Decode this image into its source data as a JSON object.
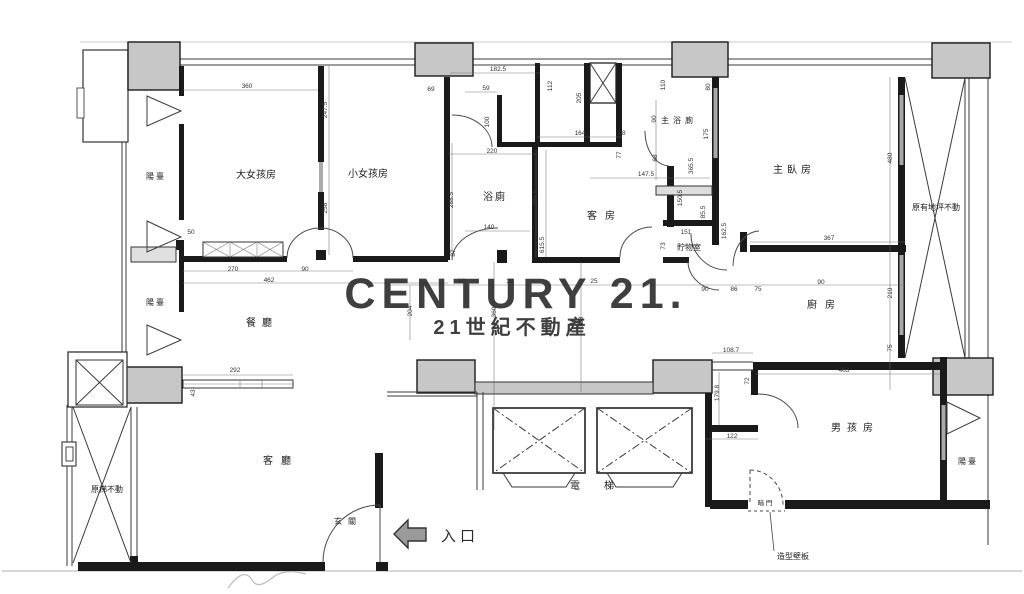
{
  "watermark": {
    "line1": "CENTURY 21.",
    "line2": "21世紀不動產",
    "color": "#c8b083"
  },
  "rooms": {
    "balcony_top_left": "陽臺",
    "balcony_mid_left": "陽臺",
    "balcony_bottom_right": "陽臺",
    "girl_big": "大女孩房",
    "girl_small": "小女孩房",
    "bath": "浴廁",
    "guest": "客房",
    "master_bath": "主浴廁",
    "master": "主臥房",
    "dining": "餐廳",
    "storage": "貯物室",
    "kitchen": "廚房",
    "living": "客廳",
    "entry": "玄關",
    "elevator": "電梯",
    "boy": "男孩房"
  },
  "notes": {
    "stair_note": "原梯不動",
    "floor_note": "原有地坪不動",
    "entrance": "入口",
    "panel_note": "造型壁板",
    "hidden_door": "暗 門"
  },
  "dims": {
    "d1": "360",
    "d2": "247.5",
    "d3": "258",
    "d4": "50",
    "d5": "69",
    "d6": "182.5",
    "d7": "59",
    "d8": "100",
    "d9": "112",
    "d10": "205",
    "d11": "110",
    "d12": "80",
    "d13": "220",
    "d14": "164",
    "d15": "48",
    "d16": "90",
    "d17": "175",
    "d18": "365.5",
    "d19": "147.5",
    "d20": "77",
    "d21": "68",
    "d22": "288.5",
    "d23": "286.5",
    "d24": "150.5",
    "d25": "85.5",
    "d26": "151",
    "d27": "73",
    "d28": "162.5",
    "d29": "480",
    "d30": "367",
    "d31": "87",
    "d32": "140",
    "d33": "615.5",
    "d34": "270",
    "d35": "90",
    "d36": "462",
    "d37": "292",
    "d38": "43",
    "d39": "80",
    "d40": "38",
    "d41": "25",
    "d42": "90",
    "d43": "86",
    "d44": "75",
    "d45": "90",
    "d46": "360",
    "d47": "318",
    "d48": "204",
    "d49": "210",
    "d50": "75",
    "d51": "108.7",
    "d52": "179.8",
    "d53": "72",
    "d54": "122",
    "d55": "463"
  }
}
